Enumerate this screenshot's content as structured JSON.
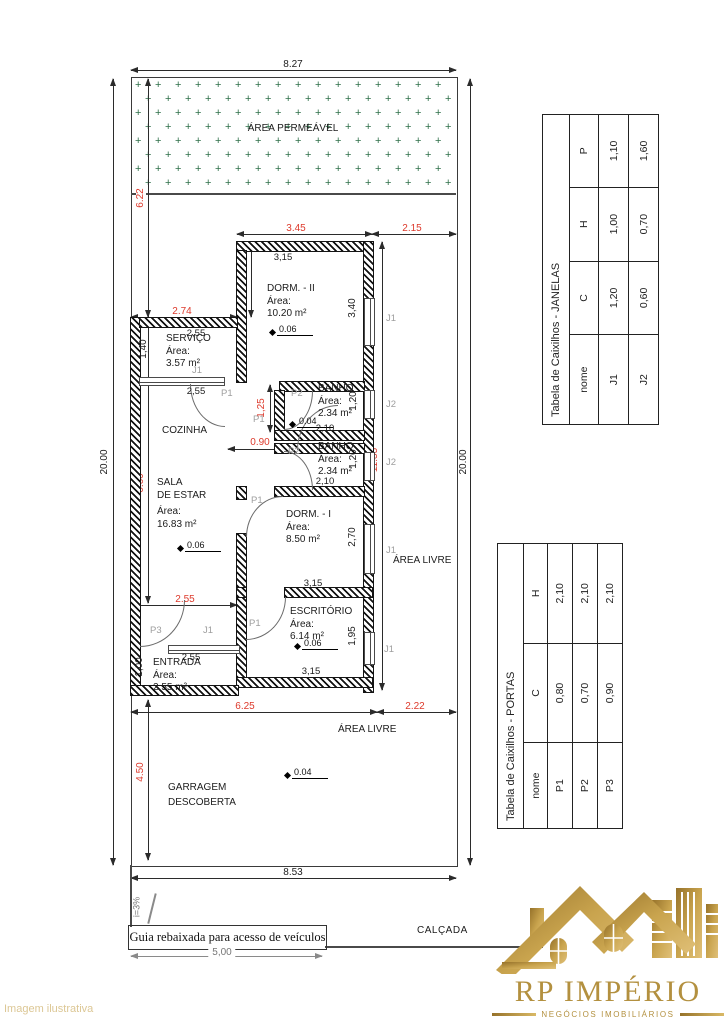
{
  "watermark": "Imagem ilustrativa",
  "plan": {
    "outer": {
      "top": "8.27",
      "left": "20.00",
      "right": "20.00",
      "bottom": "8.53",
      "driveway": "5,00"
    },
    "red_dims": {
      "d622": "6.22",
      "d345": "3.45",
      "d215": "2.15",
      "d205": "2.05",
      "d274": "2.74",
      "d125": "1,25",
      "d090": "0.90",
      "d660": "6.60",
      "d1135": "11.35",
      "d255": "2.55",
      "d625": "6.25",
      "d222": "2.22",
      "d450": "4.50"
    },
    "inner": {
      "i315a": "3,15",
      "i340": "3,40",
      "i255a": "2,55",
      "i140": "1,40",
      "i255b": "2,55",
      "i210a": "2,10",
      "i120a": "1,20",
      "i210b": "2,10",
      "i120b": "1,20",
      "i270": "2,70",
      "i315b": "3,15",
      "i315c": "3,15",
      "i195": "1,95",
      "i255c": "2,55",
      "i100": "1,00"
    },
    "areas": {
      "permeavel": "ÁREA PERMEÁVEL",
      "livre1": "ÁREA LIVRE",
      "livre2": "ÁREA LIVRE"
    },
    "rooms": {
      "dorm2": {
        "name": "DORM. - II",
        "area_label": "Área:",
        "area": "10.20 m²"
      },
      "servico": {
        "name": "SERVIÇO",
        "area_label": "Área:",
        "area": "3.57 m²"
      },
      "cozinha": {
        "name": "COZINHA"
      },
      "banho1": {
        "name": "BANHO",
        "area_label": "Área:",
        "area": "2.34 m²"
      },
      "banho2": {
        "name": "BANHO",
        "area_label": "Área:",
        "area": "2.34 m²"
      },
      "sala": {
        "name1": "SALA",
        "name2": "DE ESTAR",
        "area_label": "Área:",
        "area": "16.83 m²"
      },
      "dorm1": {
        "name": "DORM. - I",
        "area_label": "Área:",
        "area": "8.50 m²"
      },
      "escritorio": {
        "name": "ESCRITÓRIO",
        "area_label": "Área:",
        "area": "6.14 m²"
      },
      "entrada": {
        "name": "ENTRADA",
        "area_label": "Área:",
        "area": "2.55 m²"
      },
      "garagem": {
        "name1": "GARRAGEM",
        "name2": "DESCOBERTA"
      }
    },
    "elev": {
      "e1": "0.06",
      "e2": "0.04",
      "e3": "0.06",
      "e4": "0.06",
      "e5": "0.04"
    },
    "openings": {
      "p1": "P1",
      "p2": "P2",
      "p3": "P3",
      "j1": "J1",
      "j2": "J2"
    }
  },
  "tables": {
    "janelas": {
      "title": "Tabela de Caixilhos - JANELAS",
      "headers": [
        "nome",
        "C",
        "H",
        "P"
      ],
      "rows": [
        [
          "J1",
          "1,20",
          "1,00",
          "1,10"
        ],
        [
          "J2",
          "0,60",
          "0,70",
          "1,60"
        ]
      ]
    },
    "portas": {
      "title": "Tabela de Caixilhos - PORTAS",
      "headers": [
        "nome",
        "C",
        "H"
      ],
      "rows": [
        [
          "P1",
          "0,80",
          "2,10"
        ],
        [
          "P2",
          "0,70",
          "2,10"
        ],
        [
          "P3",
          "0,90",
          "2,10"
        ]
      ]
    }
  },
  "footer": {
    "guia": "Guia rebaixada para acesso de veículos",
    "calcada": "CALÇADA",
    "slope": "i=3%"
  },
  "logo": {
    "name": "RP IMPÉRIO",
    "tagline": "NEGÓCIOS IMOBILIÁRIOS"
  },
  "colors": {
    "dim_red": "#dd3a2c",
    "plus_green": "#2e6f49",
    "gold": "#b3903f",
    "opening_gray": "#9e9e9e"
  }
}
